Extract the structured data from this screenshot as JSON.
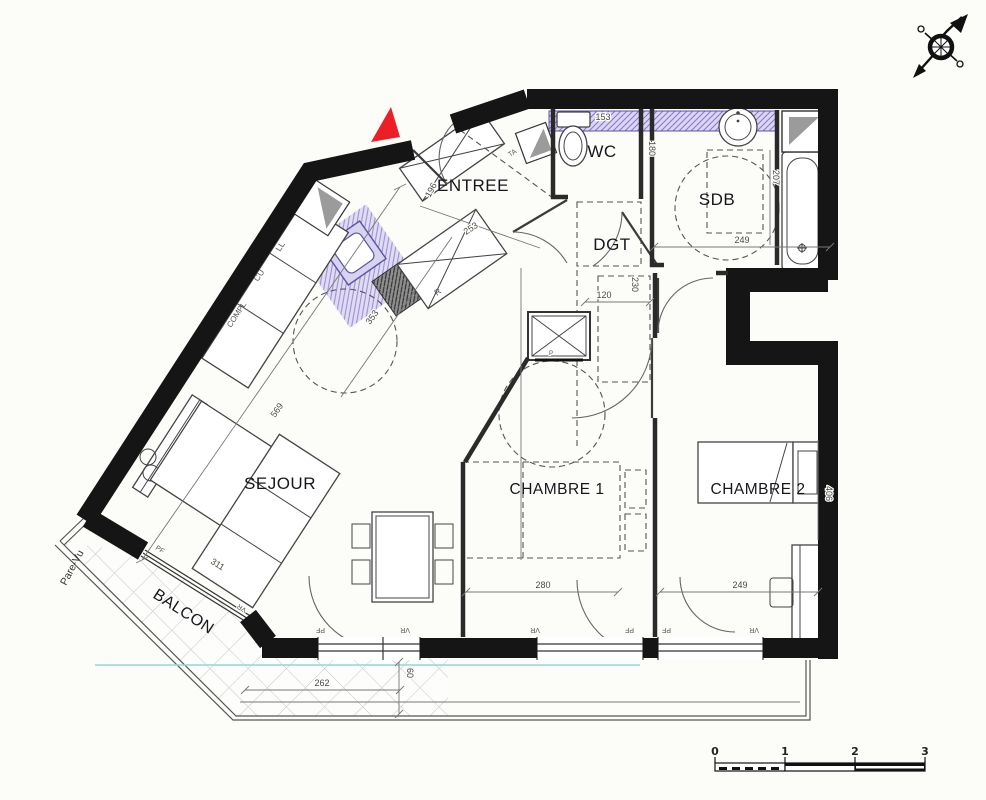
{
  "plan_title": "apartment-floor-plan",
  "rooms": {
    "entree": "ENTREE",
    "wc": "WC",
    "sdb": "SDB",
    "dgt": "DGT",
    "sejour": "SEJOUR",
    "chambre1": "CHAMBRE 1",
    "chambre2": "CHAMBRE 2",
    "balcon": "BALCON"
  },
  "labels": {
    "pare_vu": "Pare-Vu",
    "ta": "TA",
    "r": "R",
    "ll": "LL",
    "cu": "CU",
    "compl": "COMPL",
    "p": "P",
    "pf": "PF",
    "vr": "VR"
  },
  "dims": {
    "wc_width": "153",
    "wc_depth": "180",
    "sdb_width": "249",
    "sdb_depth": "207",
    "entry_a": "196",
    "entry_b": "253",
    "kitchen_diag": "353",
    "sejour_diag": "569",
    "sejour_window": "311",
    "dgt_width": "120",
    "dgt_depth": "230",
    "ch1_width": "280",
    "ch2_width": "249",
    "ch2_depth": "406",
    "balcony_width": "262",
    "balcony_depth": "60"
  },
  "scale_bar": {
    "t0": "0",
    "t1": "1",
    "t2": "2",
    "t3": "3"
  },
  "icons": {
    "compass": "compass-rose-icon",
    "north": "north-triangle-icon"
  },
  "colors": {
    "wall": "#151515",
    "hatch_purple": "#8478c8",
    "hatch_bg": "#dcd6f2",
    "accent_red": "#ec1f27",
    "cyan_line": "#8fd9d6",
    "gray_triangle": "#9b9b9b"
  }
}
